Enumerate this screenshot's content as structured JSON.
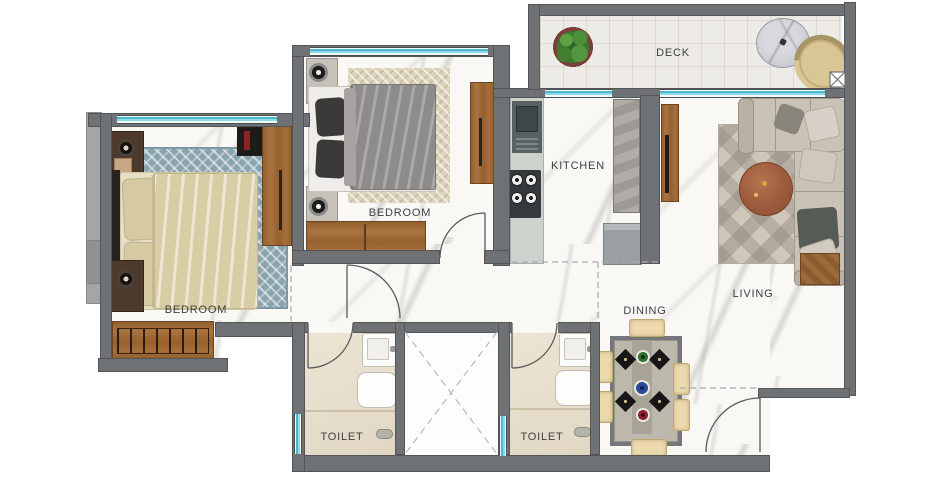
{
  "rooms": {
    "bedroom_left": {
      "label": "BEDROOM"
    },
    "bedroom_middle": {
      "label": "BEDROOM"
    },
    "kitchen": {
      "label": "KITCHEN"
    },
    "deck": {
      "label": "DECK"
    },
    "living": {
      "label": "LIVING"
    },
    "dining": {
      "label": "DINING"
    },
    "toilet_left": {
      "label": "TOILET"
    },
    "toilet_right": {
      "label": "TOILET"
    }
  },
  "palette": {
    "wall": "#6f7275",
    "window_glass": "#49b9d2",
    "marble_floor": "#f9f8f5",
    "toilet_floor": "#e9e1d1",
    "deck_floor": "#edebe6",
    "wood": "#9e6a3a",
    "rug_blue": "#8aa4ae",
    "rug_beige": "#ddd3bb",
    "sofa": "#c9c2b7",
    "coffee_table": "#9c5a3c",
    "plate_green": "#2d6b2d",
    "plate_blue": "#2a4b9b",
    "plate_red": "#8e2133"
  }
}
